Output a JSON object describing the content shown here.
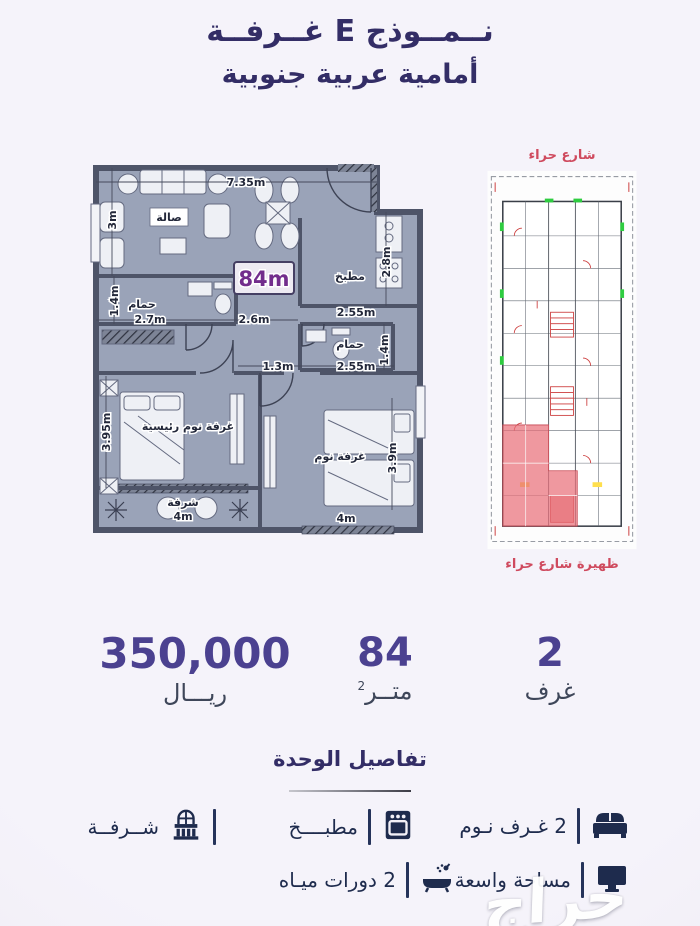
{
  "title": {
    "line1": "نــمــوذج E غــرفــة",
    "line2": "أمامية عربية جنوبية"
  },
  "floorplan": {
    "badge": "84m",
    "rooms": {
      "living": "صالة",
      "kitchen": "مطبخ",
      "bath1": "حمام",
      "bath2": "حمام",
      "master": "غرفة نوم رئيسية",
      "bedroom": "غرفة نوم",
      "balcony": "شرفة"
    },
    "dims": {
      "top": "7.35m",
      "living_h": "3m",
      "kitchen_h": "2.8m",
      "kitchen_w": "2.55m",
      "hall_left": "2.7m",
      "hall_mid": "2.6m",
      "corridor": "1.3m",
      "bath2_w": "2.55m",
      "bath1_h": "1.4m",
      "bath2_h": "1.4m",
      "master_h": "3.95m",
      "bedroom_h": "3.9m",
      "balcony_w": "4m",
      "bedroom_w": "4m"
    }
  },
  "siteplan": {
    "street_top": "شارع حراء",
    "street_bottom": "ظهيرة شارع حراء"
  },
  "stats": {
    "price": {
      "value": "350,000",
      "label": "ريـــال"
    },
    "area": {
      "value": "84",
      "label": "متــر",
      "sup": "2"
    },
    "rooms": {
      "value": "2",
      "label": "غرف"
    }
  },
  "details": {
    "heading": "تفاصيل الوحدة",
    "items": [
      {
        "id": "bedrooms",
        "label": "2 غـرف نـوم"
      },
      {
        "id": "kitchen",
        "label": "مطبــــخ"
      },
      {
        "id": "balcony",
        "label": "شــرفــة"
      },
      {
        "id": "space",
        "label": "مساحة واسعة"
      },
      {
        "id": "baths",
        "label": "2 دورات ميـاه"
      }
    ]
  },
  "watermark": "حراج",
  "colors": {
    "title": "#332d66",
    "stat_value": "#4b4190",
    "street_red": "#cf4a5e",
    "icon_navy": "#1e2b4d",
    "plan_fill": "#9aa3b8",
    "plan_wall": "#4e5468",
    "badge_purple": "#722d8c"
  }
}
